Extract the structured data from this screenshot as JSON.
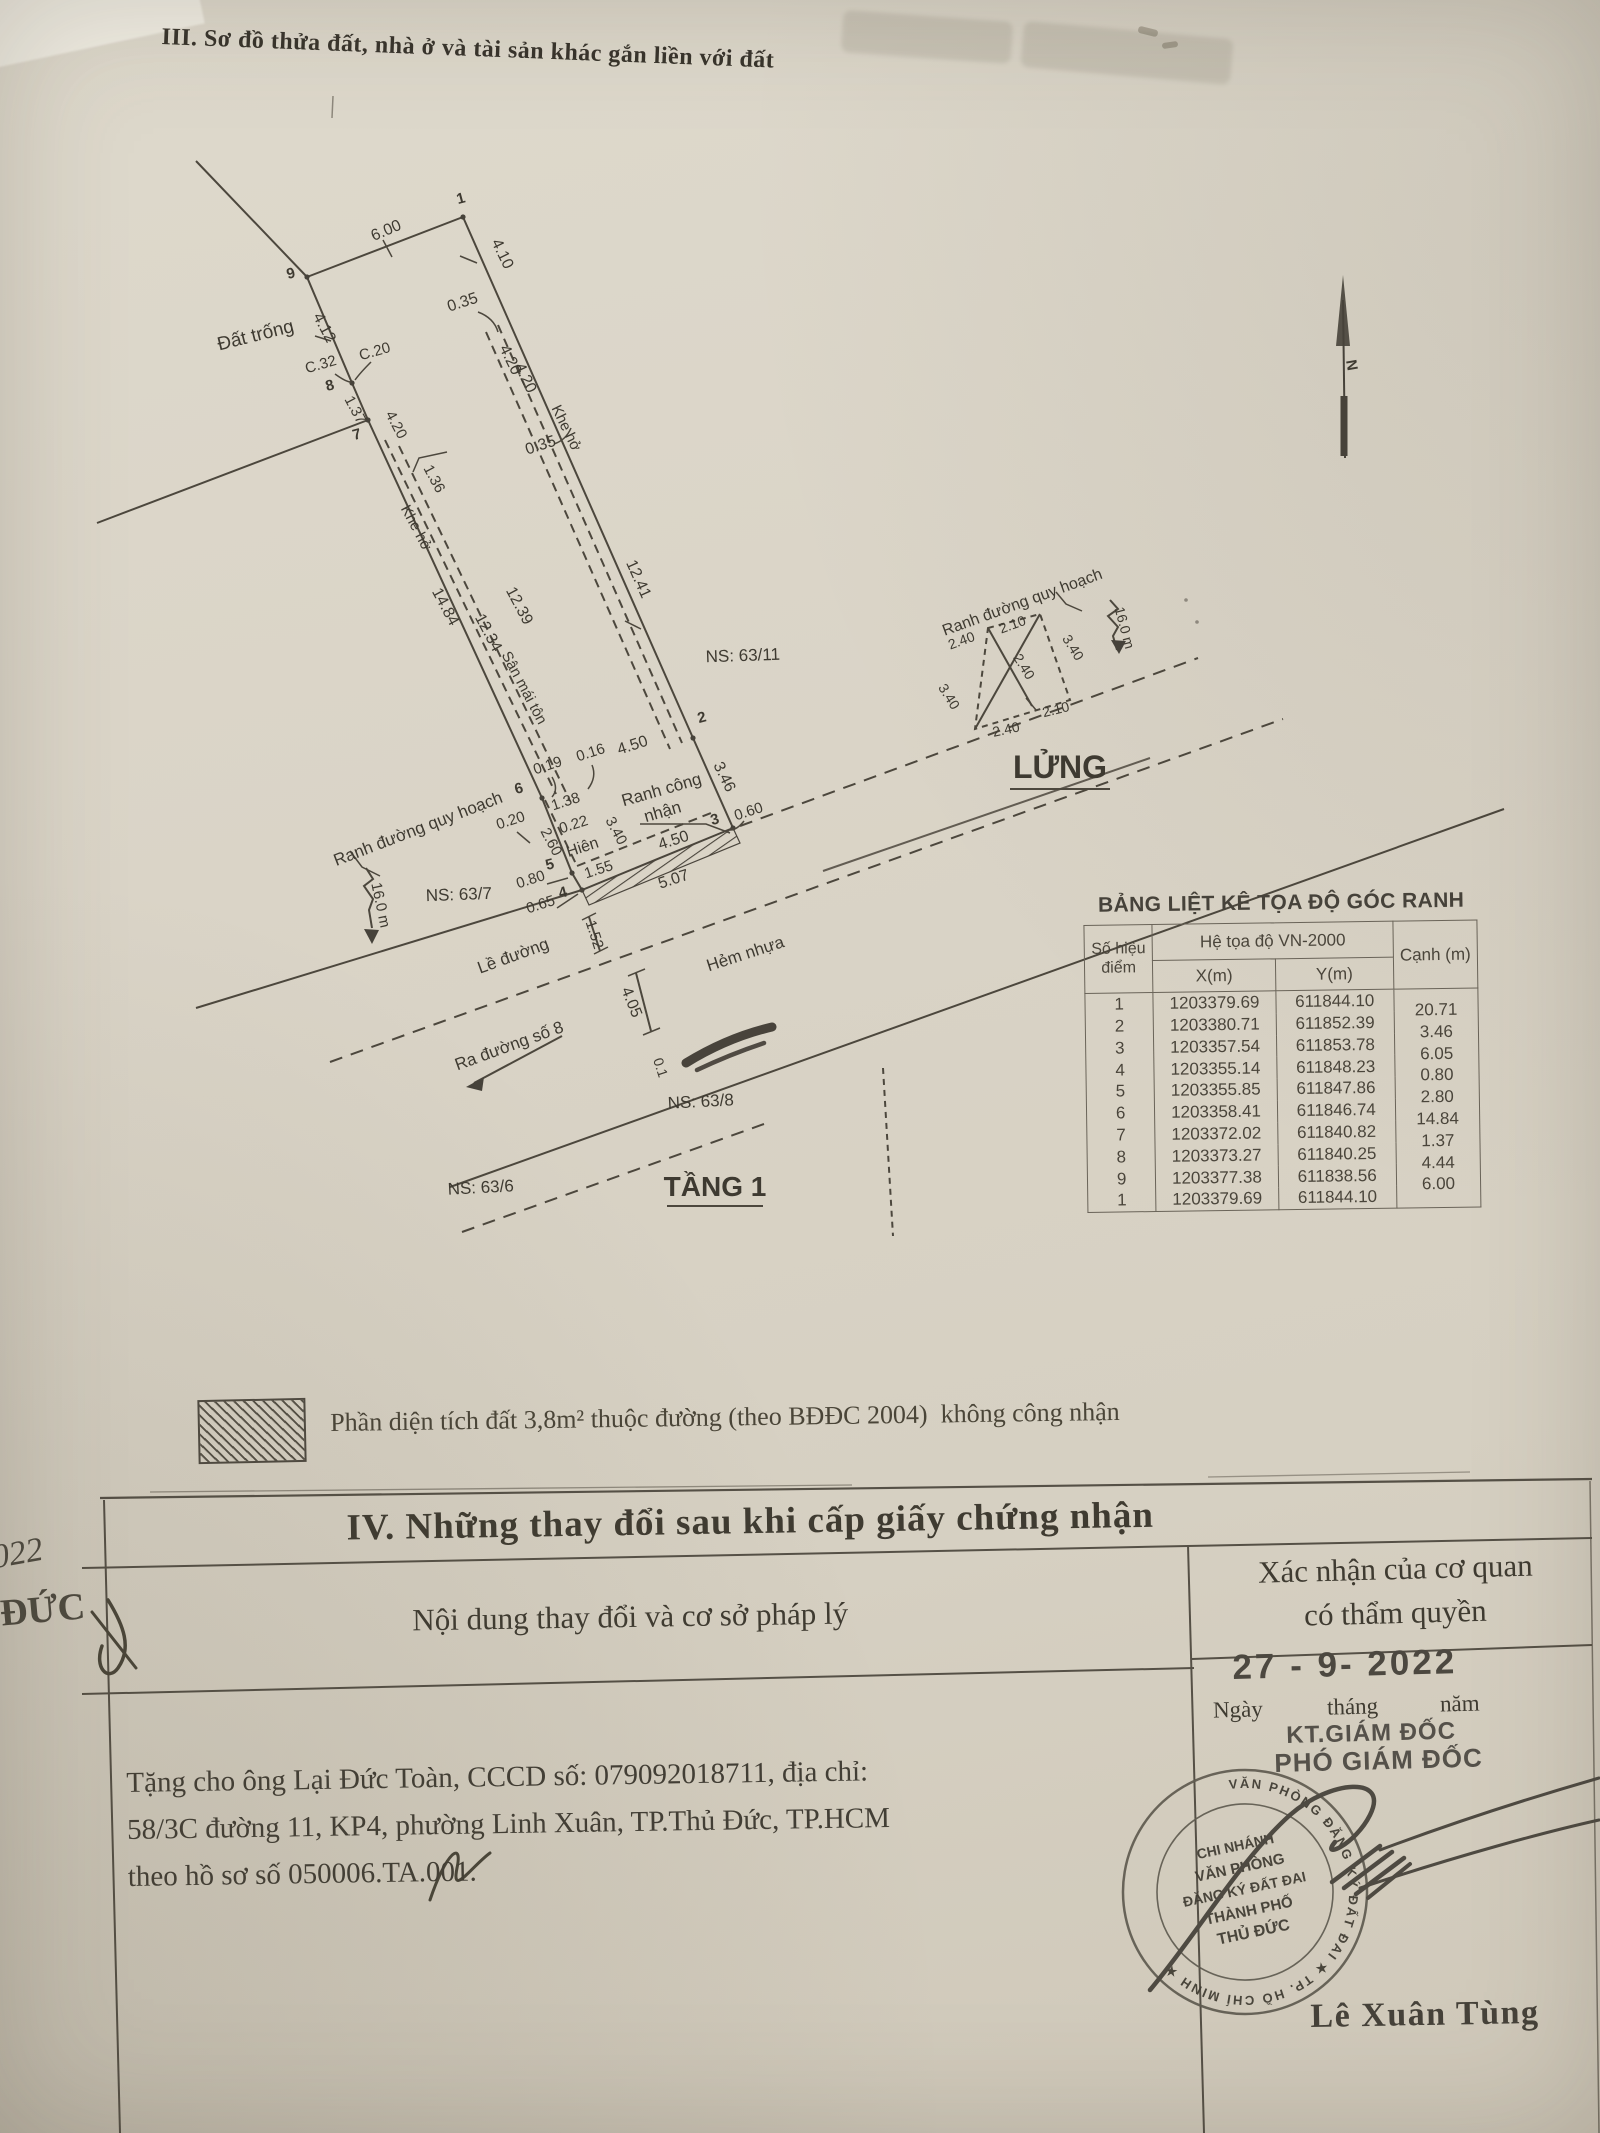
{
  "title": "III. Sơ đồ thửa đất, nhà ở và tài sản khác gắn liền với đất",
  "diagram": {
    "labels": [
      {
        "t": "1"
      },
      {
        "t": "2"
      },
      {
        "t": "3"
      },
      {
        "t": "4"
      },
      {
        "t": "5"
      },
      {
        "t": "6"
      },
      {
        "t": "7"
      },
      {
        "t": "8"
      },
      {
        "t": "9"
      },
      {
        "t": "6.00"
      },
      {
        "t": "4.10"
      },
      {
        "t": "0.35"
      },
      {
        "t": "4.20"
      },
      {
        "t": "4.20"
      },
      {
        "t": "Khe hở"
      },
      {
        "t": "0.35"
      },
      {
        "t": "12.41"
      },
      {
        "t": "Đất trống"
      },
      {
        "t": "4.12"
      },
      {
        "t": "C.32"
      },
      {
        "t": "C.20"
      },
      {
        "t": "1.37"
      },
      {
        "t": "4.20"
      },
      {
        "t": "1.36"
      },
      {
        "t": "Khe hở"
      },
      {
        "t": "14.84"
      },
      {
        "t": "12.39"
      },
      {
        "t": "12.34"
      },
      {
        "t": "Sân mái tôn"
      },
      {
        "t": "NS: 63/11"
      },
      {
        "t": "0.19"
      },
      {
        "t": "0.16"
      },
      {
        "t": "4.50"
      },
      {
        "t": "1.38"
      },
      {
        "t": "Ranh công"
      },
      {
        "t": "nhận"
      },
      {
        "t": "0.20"
      },
      {
        "t": "0.22"
      },
      {
        "t": "3.40"
      },
      {
        "t": "Hiên"
      },
      {
        "t": "4.50"
      },
      {
        "t": "0.60"
      },
      {
        "t": "2.60"
      },
      {
        "t": "1.55"
      },
      {
        "t": "0.80"
      },
      {
        "t": "0.65"
      },
      {
        "t": "5.07"
      },
      {
        "t": "3.46"
      },
      {
        "t": "Ranh đường quy hoạch"
      },
      {
        "t": "NS: 63/7"
      },
      {
        "t": "16.0 m"
      },
      {
        "t": "Lề đường"
      },
      {
        "t": "1.52"
      },
      {
        "t": "Hẻm nhựa"
      },
      {
        "t": "4.05"
      },
      {
        "t": "Ra đường số 8"
      },
      {
        "t": "NS: 63/8"
      },
      {
        "t": "NS: 63/6"
      },
      {
        "t": "TẦNG 1"
      },
      {
        "t": "Ranh đường quy hoạch"
      },
      {
        "t": "2.40"
      },
      {
        "t": "2.10"
      },
      {
        "t": "3.40"
      },
      {
        "t": "3.40"
      },
      {
        "t": "2.40"
      },
      {
        "t": "2.10"
      },
      {
        "t": "2.40"
      },
      {
        "t": "16.0 m"
      },
      {
        "t": "LỬNG"
      },
      {
        "t": "N"
      },
      {
        "t": "0.1"
      }
    ]
  },
  "coord_table": {
    "title": "BẢNG LIỆT KÊ TỌA ĐỘ GÓC RANH",
    "col_point": "Số hiệu điểm",
    "col_sys": "Hệ tọa độ VN-2000",
    "col_x": "X(m)",
    "col_y": "Y(m)",
    "col_edge": "Cạnh (m)",
    "rows": [
      [
        "1",
        "1203379.69",
        "611844.10"
      ],
      [
        "2",
        "1203380.71",
        "611852.39"
      ],
      [
        "3",
        "1203357.54",
        "611853.78"
      ],
      [
        "4",
        "1203355.14",
        "611848.23"
      ],
      [
        "5",
        "1203355.85",
        "611847.86"
      ],
      [
        "6",
        "1203358.41",
        "611846.74"
      ],
      [
        "7",
        "1203372.02",
        "611840.82"
      ],
      [
        "8",
        "1203373.27",
        "611840.25"
      ],
      [
        "9",
        "1203377.38",
        "611838.56"
      ],
      [
        "1",
        "1203379.69",
        "611844.10"
      ]
    ],
    "edges": [
      "20.71",
      "3.46",
      "6.05",
      "0.80",
      "2.80",
      "14.84",
      "1.37",
      "4.44",
      "6.00"
    ]
  },
  "legend": {
    "note": "Phần diện tích đất 3,8m² thuộc đường (theo BĐĐC 2004)  không công nhận"
  },
  "section4": {
    "heading": "IV. Những thay đổi sau khi cấp giấy chứng nhận",
    "col_left": "Nội dung thay đổi và cơ sở pháp lý",
    "col_right_1": "Xác nhận của cơ quan",
    "col_right_2": "có thẩm quyền",
    "date_stamp": "27 - 9- 2022",
    "date_day": "Ngày",
    "date_month": "tháng",
    "date_year": "năm",
    "kt_line": "KT.GIÁM ĐỐC",
    "deputy_line": "PHÓ GIÁM ĐỐC",
    "content_lines": [
      "Tặng cho ông Lại Đức Toàn, CCCD số: 079092018711, địa chỉ:",
      "58/3C đường 11, KP4, phường Linh Xuân, TP.Thủ Đức, TP.HCM",
      "theo hồ sơ số 050006.TA.001."
    ],
    "signer": "Lê Xuân Tùng",
    "stamp": {
      "ring": "VĂN PHÒNG ĐĂNG KÝ ĐẤT ĐAI ★ TP. HỒ CHÍ MINH ★",
      "lines": [
        "CHI NHÁNH",
        "VĂN PHÒNG",
        "ĐĂNG KÝ ĐẤT ĐAI",
        "THÀNH PHỐ",
        "THỦ ĐỨC"
      ]
    },
    "margin_year": "022",
    "margin_text": "ĐỨC"
  }
}
